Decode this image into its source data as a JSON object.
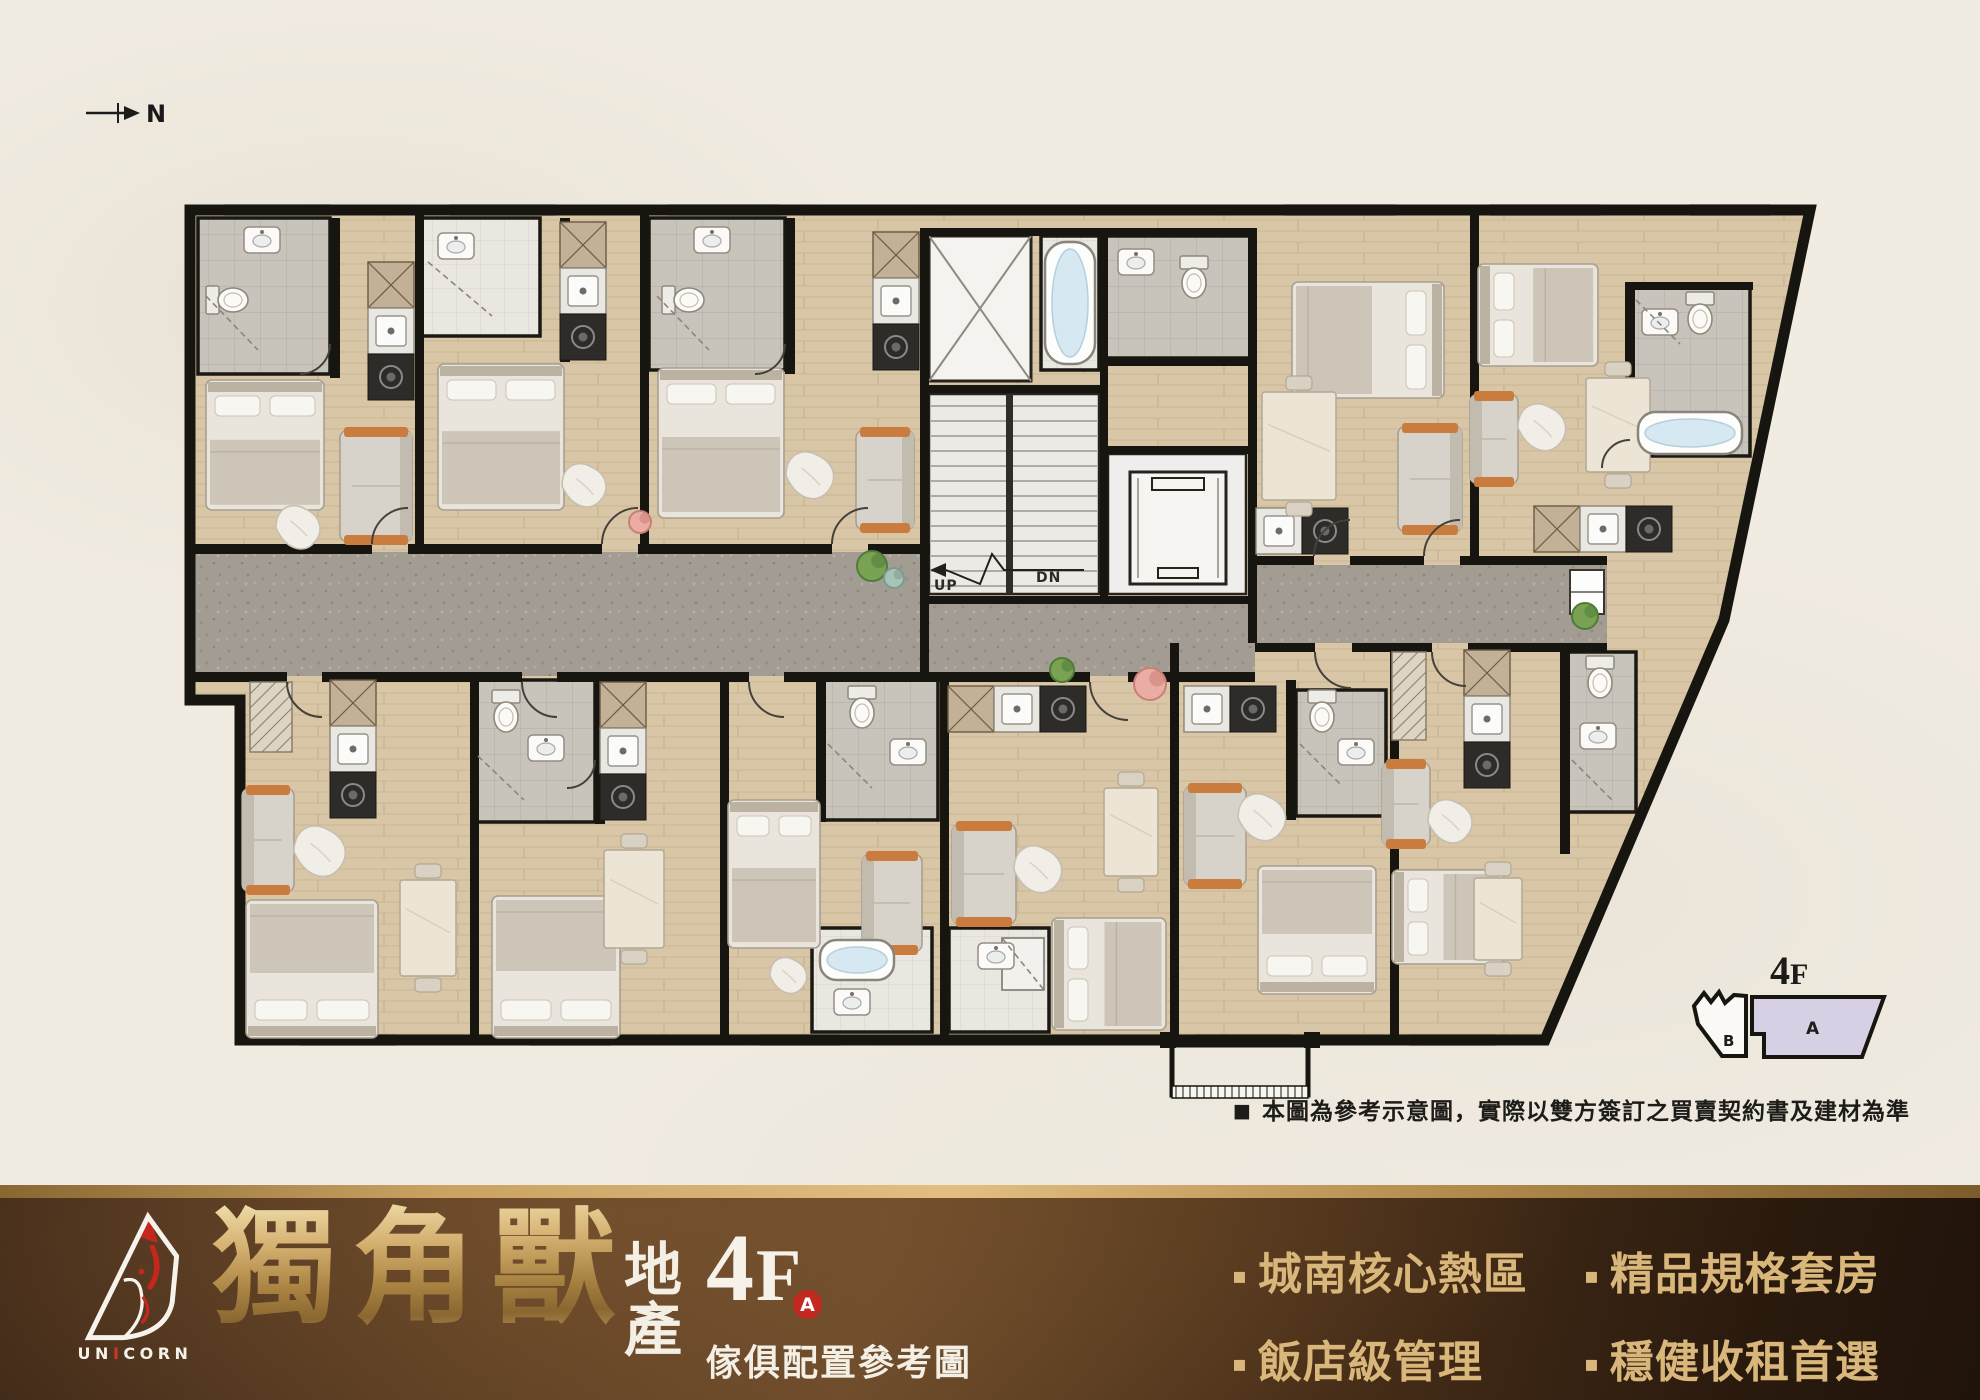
{
  "north": {
    "label": "N"
  },
  "keyplan": {
    "floor_digit": "4",
    "floor_letter": "F",
    "unit_a": "A",
    "unit_b": "B"
  },
  "disclaimer": {
    "marker": "■",
    "text": "本圖為參考示意圖，實際以雙方簽訂之買賣契約書及建材為準"
  },
  "banner": {
    "logo": {
      "pre": "UN",
      "mid": "I",
      "post": "CORN"
    },
    "title": "獨角獸",
    "suffix_top": "地",
    "suffix_bottom": "產",
    "floor_digit": "4",
    "floor_letter": "F",
    "unit_badge": "A",
    "caption": "傢俱配置參考圖",
    "bullet_marker": "▪",
    "bullets": [
      "城南核心熱區",
      "精品規格套房",
      "飯店級管理",
      "穩健收租首選"
    ],
    "colors": {
      "gold": "#d9b77b",
      "red": "#c32920",
      "brown_dark": "#2a1a0e",
      "brown_mid": "#6b4a2a"
    }
  },
  "plan": {
    "labels": {
      "up": "UP",
      "dn": "DN"
    },
    "colors": {
      "wall": "#17150f",
      "wood": "#d8c6a6",
      "corridor": "#a39c93",
      "tile_grey": "#c8c3bb",
      "tile_white": "#eae7e1",
      "keyplan_a_fill": "#d7cfe4",
      "water": "#d6e8f1",
      "accent_orange": "#c97c3e"
    },
    "outline": "190,210 1810,210 1724,620 1545,1040 240,1040 240,700 190,700",
    "corridors": [
      [
        195,
        552,
        735,
        124
      ],
      [
        1255,
        565,
        352,
        78
      ],
      [
        925,
        604,
        330,
        72
      ]
    ],
    "balcony": {
      "deck": [
        1172,
        1045,
        136,
        50
      ],
      "rail": [
        1172,
        1086,
        136,
        12
      ]
    },
    "baths": [
      [
        198,
        218,
        132,
        156,
        "g"
      ],
      [
        422,
        218,
        118,
        118,
        "w"
      ],
      [
        649,
        218,
        136,
        152,
        "g"
      ],
      [
        1103,
        236,
        147,
        122,
        "g"
      ],
      [
        1630,
        286,
        120,
        170,
        "g"
      ],
      [
        472,
        680,
        123,
        142,
        "g"
      ],
      [
        822,
        680,
        116,
        140,
        "g"
      ],
      [
        1296,
        690,
        90,
        126,
        "g"
      ],
      [
        1566,
        652,
        70,
        160,
        "g"
      ],
      [
        812,
        928,
        120,
        104,
        "w"
      ],
      [
        949,
        928,
        100,
        104,
        "w"
      ],
      [
        1041,
        236,
        58,
        134,
        "w"
      ]
    ],
    "shaft": [
      929,
      236,
      102,
      145
    ],
    "stair": {
      "room": [
        929,
        394,
        170,
        200
      ],
      "stringer": [
        1006,
        394,
        7,
        200
      ],
      "arrow": "1084,570 1004,570 992,554 980,584 946,570",
      "head": "946,563 930,570 946,577"
    },
    "elevator": {
      "room": [
        1108,
        454,
        138,
        140
      ],
      "car": [
        1130,
        472,
        96,
        112
      ],
      "bars": [
        [
          1152,
          478,
          52,
          12
        ],
        [
          1158,
          568,
          40,
          10
        ]
      ]
    },
    "windows": [
      [
        225,
        205,
        105
      ],
      [
        450,
        205,
        105
      ],
      [
        668,
        205,
        112
      ],
      [
        1285,
        205,
        110
      ],
      [
        1490,
        205,
        110
      ],
      [
        1690,
        205,
        80
      ],
      [
        300,
        1035,
        95
      ],
      [
        530,
        1035,
        80
      ],
      [
        760,
        1035,
        80
      ],
      [
        1410,
        1035,
        85
      ],
      [
        1195,
        1035,
        95
      ]
    ],
    "walls": [
      [
        190,
        544,
        182,
        10
      ],
      [
        408,
        544,
        194,
        10
      ],
      [
        638,
        544,
        194,
        10
      ],
      [
        868,
        544,
        62,
        10
      ],
      [
        1255,
        556,
        59,
        9
      ],
      [
        1350,
        556,
        74,
        9
      ],
      [
        1460,
        556,
        147,
        9
      ],
      [
        190,
        672,
        97,
        10
      ],
      [
        322,
        672,
        200,
        10
      ],
      [
        557,
        672,
        192,
        10
      ],
      [
        784,
        672,
        306,
        10
      ],
      [
        1128,
        672,
        127,
        10
      ],
      [
        1255,
        643,
        60,
        9
      ],
      [
        1352,
        643,
        80,
        9
      ],
      [
        1468,
        643,
        139,
        9
      ],
      [
        415,
        210,
        9,
        334
      ],
      [
        640,
        210,
        9,
        334
      ],
      [
        1470,
        210,
        9,
        346
      ],
      [
        920,
        228,
        9,
        368
      ],
      [
        920,
        596,
        9,
        80
      ],
      [
        1248,
        228,
        9,
        415
      ],
      [
        925,
        228,
        330,
        8
      ],
      [
        925,
        385,
        183,
        8
      ],
      [
        1100,
        228,
        8,
        376
      ],
      [
        1103,
        358,
        147,
        8
      ],
      [
        925,
        596,
        330,
        8
      ],
      [
        1105,
        446,
        145,
        8
      ],
      [
        470,
        676,
        9,
        364
      ],
      [
        720,
        676,
        9,
        364
      ],
      [
        940,
        676,
        9,
        364
      ],
      [
        1170,
        643,
        9,
        397
      ],
      [
        1390,
        643,
        9,
        397
      ],
      [
        330,
        218,
        10,
        160
      ],
      [
        560,
        218,
        10,
        144
      ],
      [
        785,
        218,
        10,
        156
      ],
      [
        595,
        676,
        10,
        148
      ],
      [
        816,
        676,
        10,
        146
      ],
      [
        1286,
        680,
        10,
        140
      ],
      [
        1560,
        650,
        10,
        204
      ],
      [
        1625,
        282,
        10,
        178
      ],
      [
        1625,
        282,
        128,
        8
      ],
      [
        1160,
        1032,
        16,
        16
      ],
      [
        1304,
        1032,
        16,
        16
      ]
    ],
    "kitchens": [
      [
        368,
        262,
        "v",
        "xso"
      ],
      [
        560,
        222,
        "v",
        "xso"
      ],
      [
        873,
        232,
        "v",
        "xso"
      ],
      [
        1256,
        508,
        "h",
        "so"
      ],
      [
        1534,
        506,
        "h",
        "xso"
      ],
      [
        330,
        680,
        "v",
        "xso"
      ],
      [
        600,
        682,
        "v",
        "xso"
      ],
      [
        948,
        686,
        "h",
        "xso"
      ],
      [
        1184,
        686,
        "h",
        "so"
      ],
      [
        1464,
        650,
        "v",
        "xso"
      ]
    ],
    "closets": [
      [
        250,
        682,
        42,
        70
      ],
      [
        1392,
        652,
        34,
        88
      ]
    ],
    "fridge": [
      1570,
      570,
      34,
      44
    ],
    "beds": [
      [
        206,
        380,
        118,
        130,
        "t"
      ],
      [
        438,
        364,
        126,
        146,
        "t"
      ],
      [
        658,
        368,
        126,
        150,
        "t"
      ],
      [
        1292,
        282,
        152,
        116,
        "r"
      ],
      [
        1478,
        264,
        120,
        102,
        "l"
      ],
      [
        246,
        900,
        132,
        138,
        "b"
      ],
      [
        492,
        896,
        128,
        142,
        "b"
      ],
      [
        728,
        800,
        92,
        148,
        "t"
      ],
      [
        1052,
        918,
        114,
        112,
        "l"
      ],
      [
        1258,
        866,
        118,
        128,
        "b"
      ],
      [
        1392,
        870,
        112,
        94,
        "l"
      ]
    ],
    "sofas": [
      [
        340,
        430,
        72,
        112,
        "r"
      ],
      [
        856,
        430,
        58,
        100,
        "r"
      ],
      [
        1398,
        426,
        64,
        106,
        "r"
      ],
      [
        1470,
        394,
        48,
        90,
        "l"
      ],
      [
        242,
        788,
        52,
        104,
        "l"
      ],
      [
        862,
        854,
        60,
        98,
        "l"
      ],
      [
        952,
        824,
        64,
        100,
        "l"
      ],
      [
        1184,
        786,
        62,
        100,
        "l"
      ],
      [
        1382,
        762,
        48,
        84,
        "l"
      ]
    ],
    "blobs": [
      [
        300,
        528,
        24
      ],
      [
        586,
        486,
        24
      ],
      [
        812,
        476,
        26
      ],
      [
        1544,
        428,
        26
      ],
      [
        322,
        852,
        28
      ],
      [
        790,
        976,
        20
      ],
      [
        1040,
        870,
        26
      ],
      [
        1264,
        818,
        26
      ],
      [
        1452,
        822,
        24
      ]
    ],
    "dining": [
      [
        1262,
        392,
        74,
        108
      ],
      [
        1586,
        378,
        64,
        94
      ],
      [
        400,
        880,
        56,
        96
      ],
      [
        604,
        850,
        60,
        98
      ],
      [
        1104,
        788,
        54,
        88
      ],
      [
        1474,
        878,
        48,
        82
      ]
    ],
    "tubs": [
      [
        1045,
        242,
        50,
        122
      ],
      [
        1638,
        412,
        104,
        42
      ],
      [
        820,
        940,
        74,
        40
      ]
    ],
    "showers": [
      [
        1002,
        938,
        42,
        52
      ]
    ],
    "toilets": [
      [
        232,
        300,
        -90
      ],
      [
        688,
        300,
        -90
      ],
      [
        1194,
        282,
        0
      ],
      [
        1700,
        318,
        0
      ],
      [
        506,
        716,
        0
      ],
      [
        862,
        712,
        0
      ],
      [
        1322,
        716,
        0
      ],
      [
        1600,
        682,
        0
      ]
    ],
    "sinks": [
      [
        262,
        240
      ],
      [
        456,
        246
      ],
      [
        712,
        240
      ],
      [
        1136,
        262
      ],
      [
        1660,
        322
      ],
      [
        546,
        748
      ],
      [
        908,
        752
      ],
      [
        1356,
        752
      ],
      [
        1598,
        736
      ],
      [
        996,
        956
      ],
      [
        852,
        1002
      ]
    ],
    "doors": [
      "M372 544 A36 36 0 0 1 408 508",
      "M602 544 A36 36 0 0 1 638 508",
      "M832 544 A36 36 0 0 1 868 508",
      "M1314 556 A36 36 0 0 1 1350 520",
      "M1424 556 A36 36 0 0 1 1460 520",
      "M287 682 A35 35 0 0 0 322 717",
      "M522 682 A35 35 0 0 0 557 717",
      "M749 682 A35 35 0 0 0 784 717",
      "M1090 682 A38 38 0 0 0 1128 720",
      "M1315 652 A36 36 0 0 0 1351 688",
      "M1432 652 A34 34 0 0 0 1466 686",
      "M330 344 A30 30 0 0 1 300 374",
      "M785 344 A30 30 0 0 1 755 374",
      "M595 760 A28 28 0 0 1 567 788",
      "M1630 440 A28 28 0 0 0 1602 468"
    ],
    "glass": [
      "M206 296 L258 350",
      "M428 262 L492 316",
      "M657 296 L709 350",
      "M478 756 L524 800",
      "M828 744 L872 788",
      "M1300 744 L1340 784",
      "M1572 760 L1612 800",
      "M1002 938 L1044 990",
      "M1636 300 L1680 344"
    ],
    "plants": [
      [
        872,
        566,
        15,
        "g"
      ],
      [
        894,
        578,
        10,
        "t"
      ],
      [
        1062,
        670,
        12,
        "g"
      ],
      [
        1150,
        684,
        16,
        "p"
      ],
      [
        1585,
        616,
        13,
        "g"
      ],
      [
        640,
        522,
        11,
        "p"
      ]
    ]
  }
}
